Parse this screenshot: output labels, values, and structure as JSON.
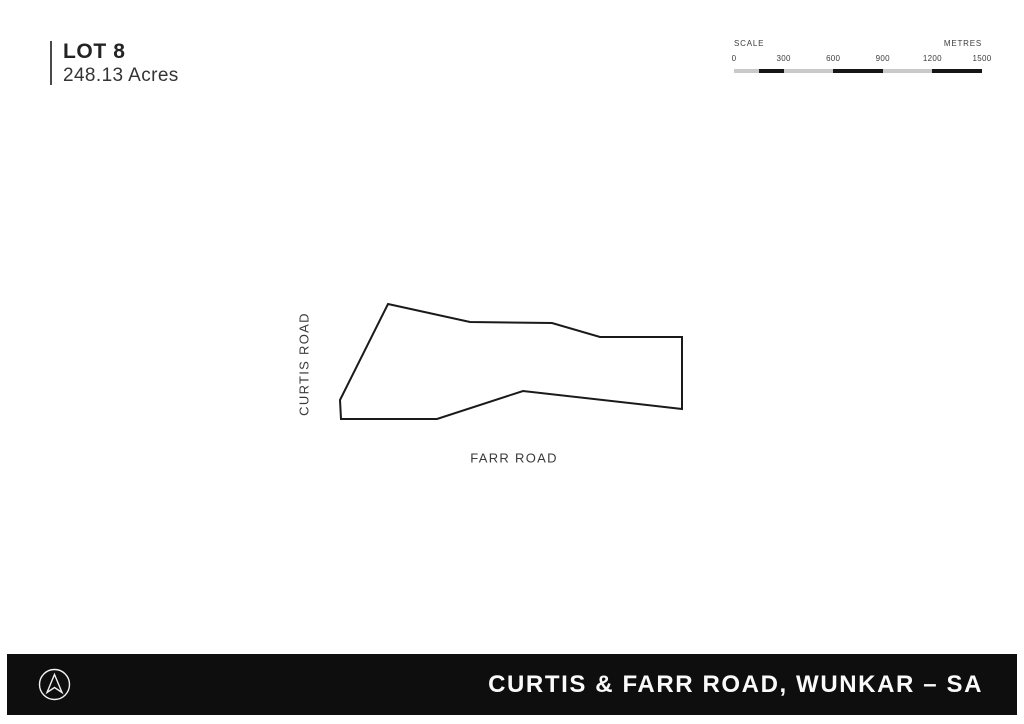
{
  "title": {
    "lot": "LOT 8",
    "area": "248.13 Acres"
  },
  "scale": {
    "label_left": "SCALE",
    "label_right": "METRES",
    "ticks": [
      "0",
      "300",
      "600",
      "900",
      "1200",
      "1500"
    ],
    "segments": [
      {
        "color": "#c9c9c9",
        "pct": 10
      },
      {
        "color": "#161616",
        "pct": 10
      },
      {
        "color": "#c9c9c9",
        "pct": 20
      },
      {
        "color": "#161616",
        "pct": 20
      },
      {
        "color": "#c9c9c9",
        "pct": 20
      },
      {
        "color": "#161616",
        "pct": 20
      }
    ]
  },
  "plan": {
    "lot_polygon_points": "58,14 140,32 222,33 270,47 352,47 352,119 193,101 107,129 11,129 10,110",
    "stroke_color": "#1a1a1a",
    "road_left": "CURTIS ROAD",
    "road_bottom": "FARR ROAD"
  },
  "footer": {
    "address": "CURTIS & FARR ROAD, WUNKAR – SA",
    "bg_color": "#0e0e0e",
    "text_color": "#fafafa",
    "logo": "north-arrow"
  }
}
